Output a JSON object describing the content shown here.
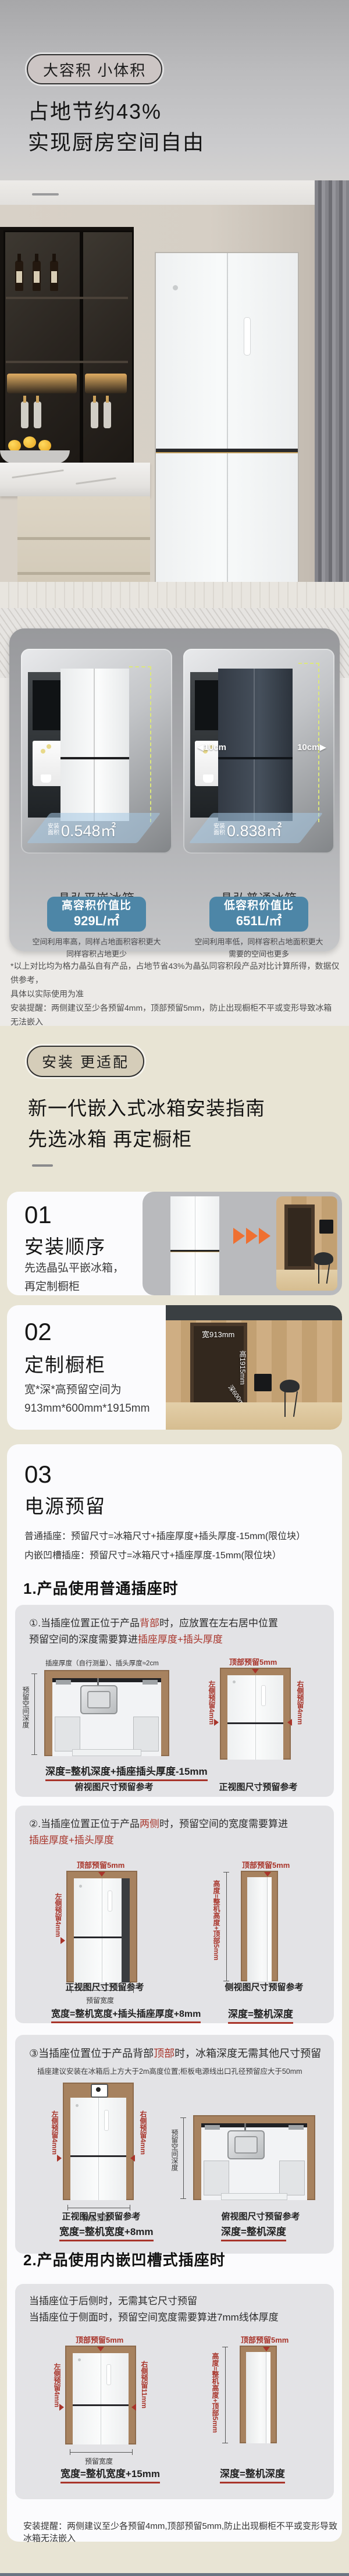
{
  "hero": {
    "badge": "大容积 小体积",
    "title_line1": "占地节约43%",
    "title_line2": "实现厨房空间自由"
  },
  "compare": {
    "left": {
      "area_label_l1": "安装",
      "area_label_l2": "面积",
      "area_value": "0.548㎡",
      "name": "晶弘平嵌冰箱",
      "badge_line1": "高容积价值比",
      "badge_line2": "929L/㎡",
      "desc_line1": "空间利用率高，同样占地面积容积更大",
      "desc_line2": "同样容积占地更少"
    },
    "right": {
      "area_label_l1": "安装",
      "area_label_l2": "面积",
      "area_value": "0.838㎡",
      "name": "晶弘普通冰箱",
      "badge_line1": "低容积价值比",
      "badge_line2": "651L/㎡",
      "desc_line1": "空间利用率低，同样容积占地面积更大",
      "desc_line2": "需要的空间也更多",
      "gap_left": "◀10cm",
      "gap_right": "10cm▶"
    },
    "note_line1": "*以上对比均为格力晶弘自有产品，占地节省43%为晶弘同容积段产品对比计算所得，数据仅供参考，",
    "note_line2": "具体以实际使用为准",
    "note_line3": "安装提醒：两侧建议至少各预留4mm，顶部预留5mm，防止出现橱柜不平或变形导致冰箱无法嵌入"
  },
  "install": {
    "badge": "安装 更适配",
    "title_line1": "新一代嵌入式冰箱安装指南",
    "title_line2": "先选冰箱 再定橱柜",
    "step1": {
      "num": "01",
      "title": "安装顺序",
      "desc_line1": "先选晶弘平嵌冰箱，",
      "desc_line2": "再定制橱柜"
    },
    "step2": {
      "num": "02",
      "title": "定制橱柜",
      "desc_line1": "宽*深*高预留空间为",
      "desc_line2": "913mm*600mm*1915mm",
      "dim_width": "宽913mm",
      "dim_height": "高1915mm",
      "dim_depth": "深600mm"
    },
    "step3": {
      "num": "03",
      "title": "电源预留",
      "intro_line1": "普通插座：预留尺寸=冰箱尺寸+插座厚度+插头厚度-15mm(限位块）",
      "intro_line2": "内嵌凹槽插座：预留尺寸=冰箱尺寸+插座厚度-15mm(限位块）"
    }
  },
  "section1": {
    "heading": "1.产品使用普通插座时",
    "case1": {
      "l1a": "①.当插座位置正位于产品",
      "l1b": "背部",
      "l1c": "时，应放置在左右居中位置",
      "l2a": "预留空间的深度需要算进",
      "l2b": "插座厚度+插头厚度",
      "top_note": "插座厚度（自行测量）、插头厚度≈2cm",
      "formula": "深度=整机深度+插座插头厚度-15mm"
    },
    "case2": {
      "l1a": "②.当插座位置正位于产品",
      "l1b": "两侧",
      "l1c": "时，预留空间的宽度需要算进",
      "l2b": "插座厚度+插头厚度",
      "formula_w": "宽度=整机宽度+插头插座厚度+8mm"
    },
    "case3": {
      "l1a": "③当插座位置位于产品背部",
      "l1b": "顶部",
      "l1c": "时，冰箱深度无需其他尺寸预留",
      "note": "插座建议安装在冰箱后上方大于2m高度位置;柜板电源线出口孔径预留应大于50mm",
      "formula_w": "宽度=整机宽度+8mm"
    }
  },
  "section2": {
    "heading": "2.产品使用内嵌凹槽式插座时",
    "l1": "当插座位于后侧时，无需其它尺寸预留",
    "l2": "当插座位于侧面时，预留空间宽度需要算进7mm线体厚度",
    "formula_w": "宽度=整机宽度+15mm",
    "subcap_front": "当插座位于两侧时",
    "subcap_side": "当插座位于后侧时"
  },
  "labels": {
    "top5": "顶部预留5mm",
    "left4": "左侧预留4mm",
    "right4": "右侧预留4mm",
    "right11": "右侧预留11mm",
    "width_bracket": "预留宽度",
    "depth_space": "预留空间深度",
    "height_formula": "高度=整机高度+顶部5mm"
  },
  "formulas": {
    "depth_eq": "深度=整机深度"
  },
  "captions": {
    "front": "正视图尺寸预留参考",
    "top": "俯视图尺寸预留参考",
    "side": "侧视图尺寸预留参考"
  },
  "footer_note": "安装提醒：两侧建议至少各预留4mm,顶部预留5mm,防止出现橱柜不平或变形导致冰箱无法嵌入"
}
